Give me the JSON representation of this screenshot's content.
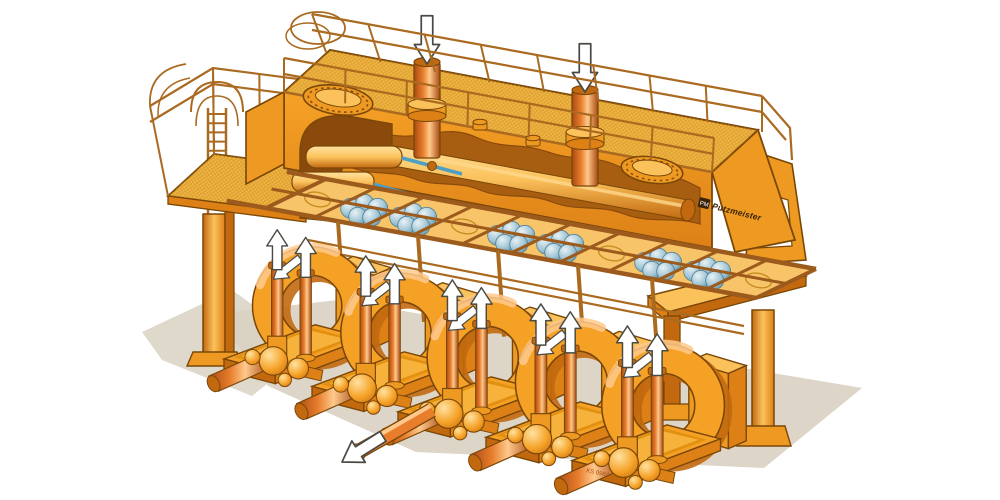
{
  "meta": {
    "title": "Piston pump station — isometric cutaway illustration",
    "style": "technical cutaway drawing, orange machinery on white background"
  },
  "brand": {
    "label": "Putzmeister",
    "monogram": "PM"
  },
  "plate": {
    "code": "KS 0984"
  },
  "palette": {
    "background": "#ffffff",
    "outline": "#7a4708",
    "orange": "#f5a126",
    "orangeLight": "#fbc25c",
    "orangePale": "#ffe2a0",
    "orangeMid": "#ee9a22",
    "orangeDark": "#dd8117",
    "orangeDeep": "#c2690f",
    "brown": "#9c5b1d",
    "rail": "#aa6a20",
    "interior": "#a85e10",
    "interiorDark": "#8a4a0c",
    "grate1": "#f3b845",
    "grate2": "#c88d22",
    "panel": "#f8c469",
    "recess": "#e2900f",
    "floor": "#f7b23b",
    "riserDark": "#a84a12",
    "riser": "#e87e2c",
    "riserHi": "#ffc98c",
    "ballLight": "#e8f2f5",
    "ballMid": "#9fc4d4",
    "ballDark": "#4e7f96",
    "rodBlue": "#4e9fc4",
    "arrowFill": "#ffffff",
    "arrowStroke": "#4a4a44",
    "shadow": "#d9d2c2",
    "plateText": "#a84b10",
    "logoDark": "#3a2206",
    "highlight": "#ffd98e"
  },
  "diagram": {
    "type": "isometric-cutaway",
    "components": [
      "top air-vessel housing with walkway grating, two manhole covers and two flanged standpipes",
      "perimeter handrails with safety-cage hoops",
      "left access platform with caged ladder and support column",
      "cutaway showing internal dampener cylinders with piston rods and long pulsation vessel",
      "valve deck with ball-valve clusters",
      "five piston pump units, each with circular housing, two riser pipes and suction manifold on a tray base",
      "discharge pipe with outlet arrow from centre pump unit",
      "right support bench with A-frame leg"
    ],
    "arrows": {
      "inlet_down": 2,
      "riser_up": 10,
      "housing_flow": 5,
      "discharge_out": 1
    },
    "valve_deck": {
      "cells": 10,
      "cluster_cells": [
        1,
        2,
        4,
        5,
        7,
        8
      ],
      "empty_cells": [
        0,
        3,
        6,
        9
      ]
    },
    "pump_units": {
      "count": 5,
      "risers_per_unit": 2,
      "positions": [
        {
          "x": 224,
          "y": 226,
          "s": 0.95
        },
        {
          "x": 312,
          "y": 252,
          "s": 0.96
        },
        {
          "x": 398,
          "y": 276,
          "s": 0.97
        },
        {
          "x": 486,
          "y": 300,
          "s": 0.98
        },
        {
          "x": 572,
          "y": 322,
          "s": 0.99
        }
      ]
    }
  }
}
